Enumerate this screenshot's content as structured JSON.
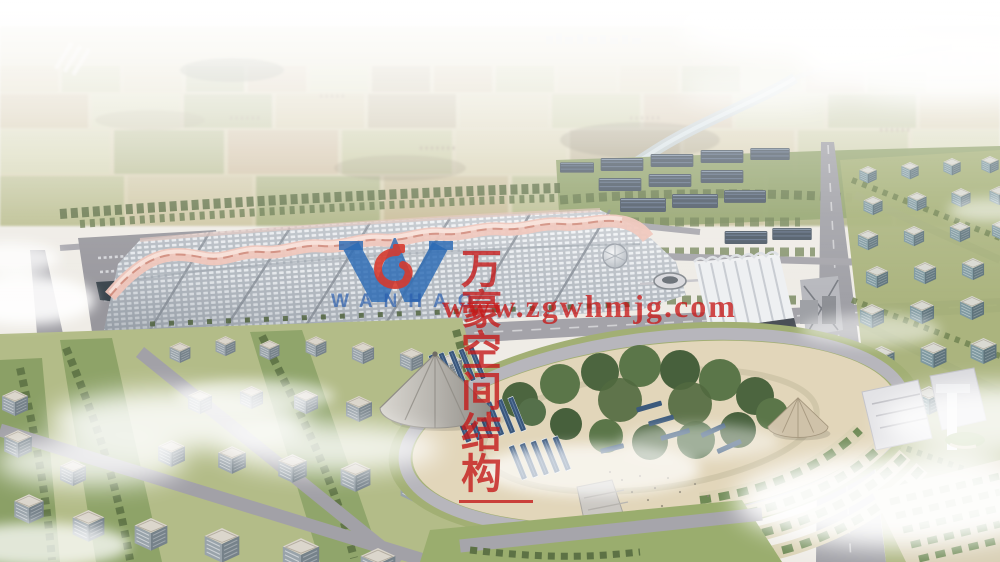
{
  "watermark": {
    "company_name_cn": "万豪空间结构",
    "website_url": "www.zgwhmjg.com",
    "logo_text": "WANHAO",
    "text_color": "#c41a1a",
    "logo_color": "#2b6ab5",
    "logo_accent_color": "#d8382b"
  }
}
